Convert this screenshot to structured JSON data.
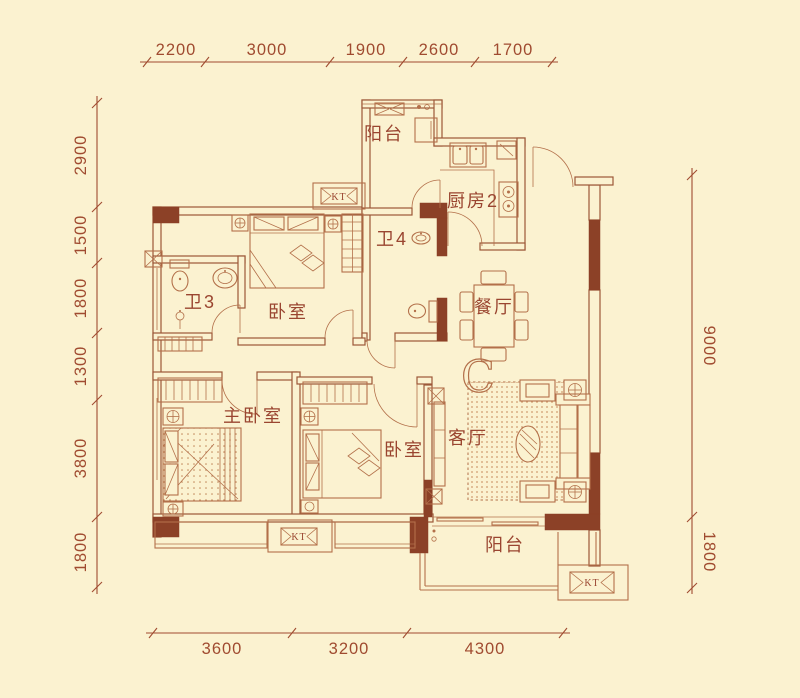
{
  "plan": {
    "rooms": {
      "balcony_top": "阳台",
      "kitchen": "厨房2",
      "bath4": "卫4",
      "bath3": "卫3",
      "bedroom_top": "卧室",
      "dining": "餐厅",
      "master_bedroom": "主卧室",
      "bedroom2": "卧室",
      "living": "客厅",
      "balcony_bottom": "阳台"
    },
    "unit_mark": "C",
    "ac_label": "KT"
  },
  "dimensions": {
    "top": [
      "2200",
      "3000",
      "1900",
      "2600",
      "1700"
    ],
    "left": [
      "2900",
      "1500",
      "1800",
      "1300",
      "3800",
      "1800"
    ],
    "right": [
      "9000",
      "1800"
    ],
    "bottom": [
      "3600",
      "3200",
      "4300"
    ]
  },
  "colors": {
    "background": "#FBF2D0",
    "line": "#B3704A",
    "wall": "#9C5838",
    "wall_fill": "#8C4127",
    "text": "#A04B30"
  }
}
